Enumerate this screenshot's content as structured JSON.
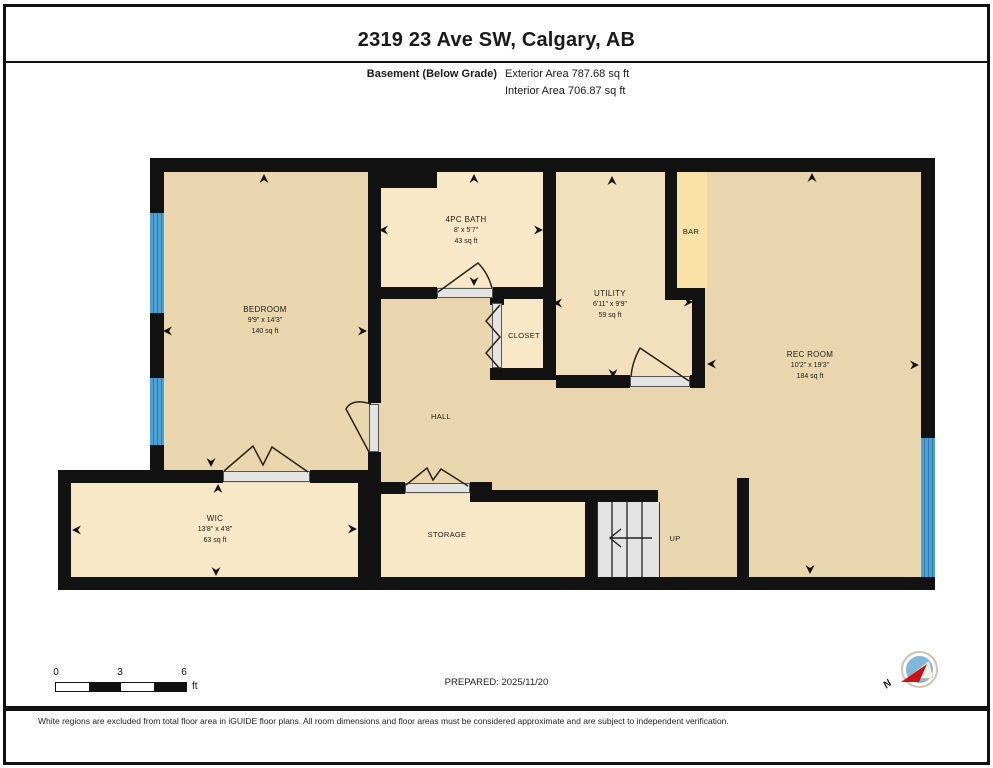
{
  "header": {
    "title": "2319 23 Ave SW, Calgary, AB",
    "floor_label": "Basement (Below Grade)",
    "exterior_area": "Exterior Area 787.68 sq ft",
    "interior_area": "Interior Area 706.87 sq ft"
  },
  "rooms": [
    {
      "name": "BEDROOM",
      "dims": "9'9\" x 14'3\"",
      "area": "140 sq ft"
    },
    {
      "name": "4PC BATH",
      "dims": "8' x 5'7\"",
      "area": "43 sq ft"
    },
    {
      "name": "UTILITY",
      "dims": "6'11\" x 9'9\"",
      "area": "59 sq ft"
    },
    {
      "name": "CLOSET"
    },
    {
      "name": "BAR"
    },
    {
      "name": "REC ROOM",
      "dims": "10'2\" x 19'3\"",
      "area": "184 sq ft"
    },
    {
      "name": "HALL"
    },
    {
      "name": "WIC",
      "dims": "13'8\" x 4'8\"",
      "area": "63 sq ft"
    },
    {
      "name": "STORAGE"
    },
    {
      "name": "UP"
    }
  ],
  "scale_bar": {
    "ticks": [
      "0",
      "3",
      "6"
    ],
    "unit": "ft"
  },
  "footer": {
    "prepared": "PREPARED: 2025/11/20",
    "disclaimer": "White regions are excluded from total floor area in iGUIDE floor plans. All room dimensions and floor areas must be considered approximate and are subject to independent verification."
  },
  "compass": {
    "north_label": "N"
  },
  "colors": {
    "wall": "#121212",
    "floor_main": "#e9d5ae",
    "floor_light": "#f8e8c8",
    "floor_utility": "#f2dfbc",
    "floor_bar": "#f8e2a8",
    "window_blue": "#4ba1d3",
    "stair_gray": "#e3e3e3"
  }
}
